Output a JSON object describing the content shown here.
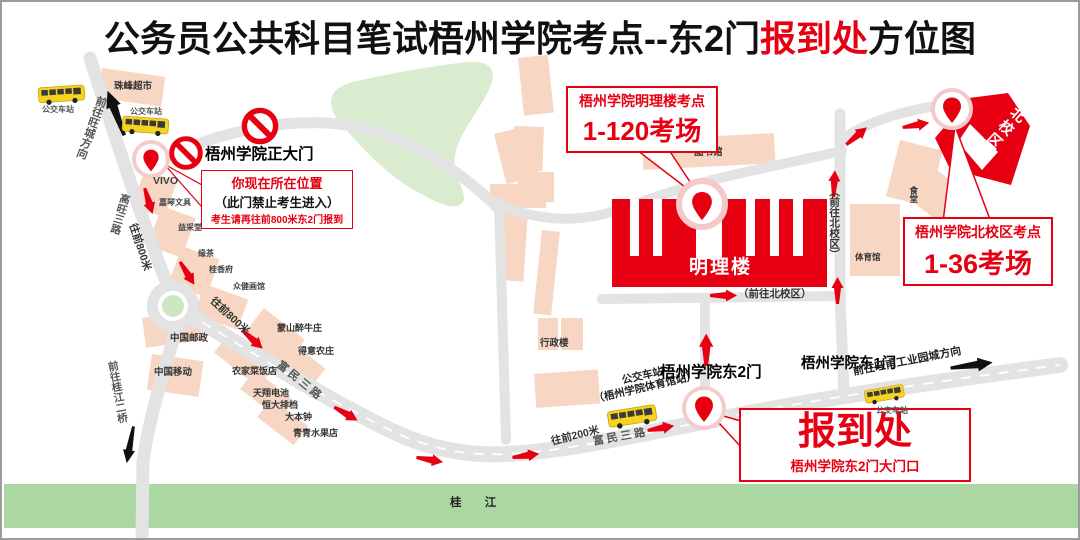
{
  "title": {
    "prefix": "公务员公共科目笔试梧州学院考点--东2门",
    "highlight": "报到处",
    "suffix": "方位图"
  },
  "callouts": {
    "minglilou": {
      "line1": "梧州学院明理楼考点",
      "line2": "1-120考场"
    },
    "north": {
      "line1": "梧州学院北校区考点",
      "line2": "1-36考场"
    },
    "checkin": {
      "line1": "报到处",
      "line2": "梧州学院东2门大门口"
    },
    "location": {
      "line1": "你现在所在位置",
      "line2": "（此门禁止考生进入）",
      "line3": "考生请再往前800米东2门报到"
    }
  },
  "gates": {
    "main": "梧州学院正大门",
    "east2": "梧州学院东2门",
    "east1": "梧州学院东1门"
  },
  "buildings": {
    "minglilou": "明理楼",
    "library": "图书馆",
    "admin": "行政楼",
    "gym": "体育馆",
    "north_campus": "北校区",
    "canteen": "食堂",
    "supermarket": "珠峰超市"
  },
  "roads": {
    "gaowang": "高旺三路",
    "fumin_upper": "富民三路",
    "fumin_lower": "富民三路",
    "to_wangcheng": "前往旺城方向",
    "to_bridge": "前往桂江二桥",
    "to_north_v": "（前往北校区）",
    "to_north_h": "（前往北校区）",
    "to_wangfu": "前往旺甫工业园城方向"
  },
  "river": "桂 江",
  "distances": {
    "m800_a": "往前800米",
    "m800_b": "往前800米",
    "m200": "往前200米"
  },
  "bus": {
    "stop": "公交车站",
    "gym_station_line1": "公交车站",
    "gym_station_line2": "（梧州学院体育馆站）"
  },
  "shops": {
    "vivo": "VIVO",
    "stationery": "嘉琴文具",
    "yicai": "益采堂",
    "tea": "缘茶",
    "guixiang": "桂香府",
    "gallery": "众健画馆",
    "post": "中国邮政",
    "mobile": "中国移动",
    "restaurant": "农家菜饭店",
    "battery": "天翔电池",
    "bbq": "恒大排档",
    "dabenzhong": "大本钟",
    "fruit": "青青水果店",
    "beef": "蒙山醉牛庄",
    "farm": "得意农庄"
  },
  "colors": {
    "accent_red": "#e60012",
    "road_gray": "#e3e3e3",
    "building_pink": "#f7d6c3",
    "green_area": "#d9ecd0",
    "river_green": "#abd7a2",
    "bus_yellow": "#f6d321"
  }
}
